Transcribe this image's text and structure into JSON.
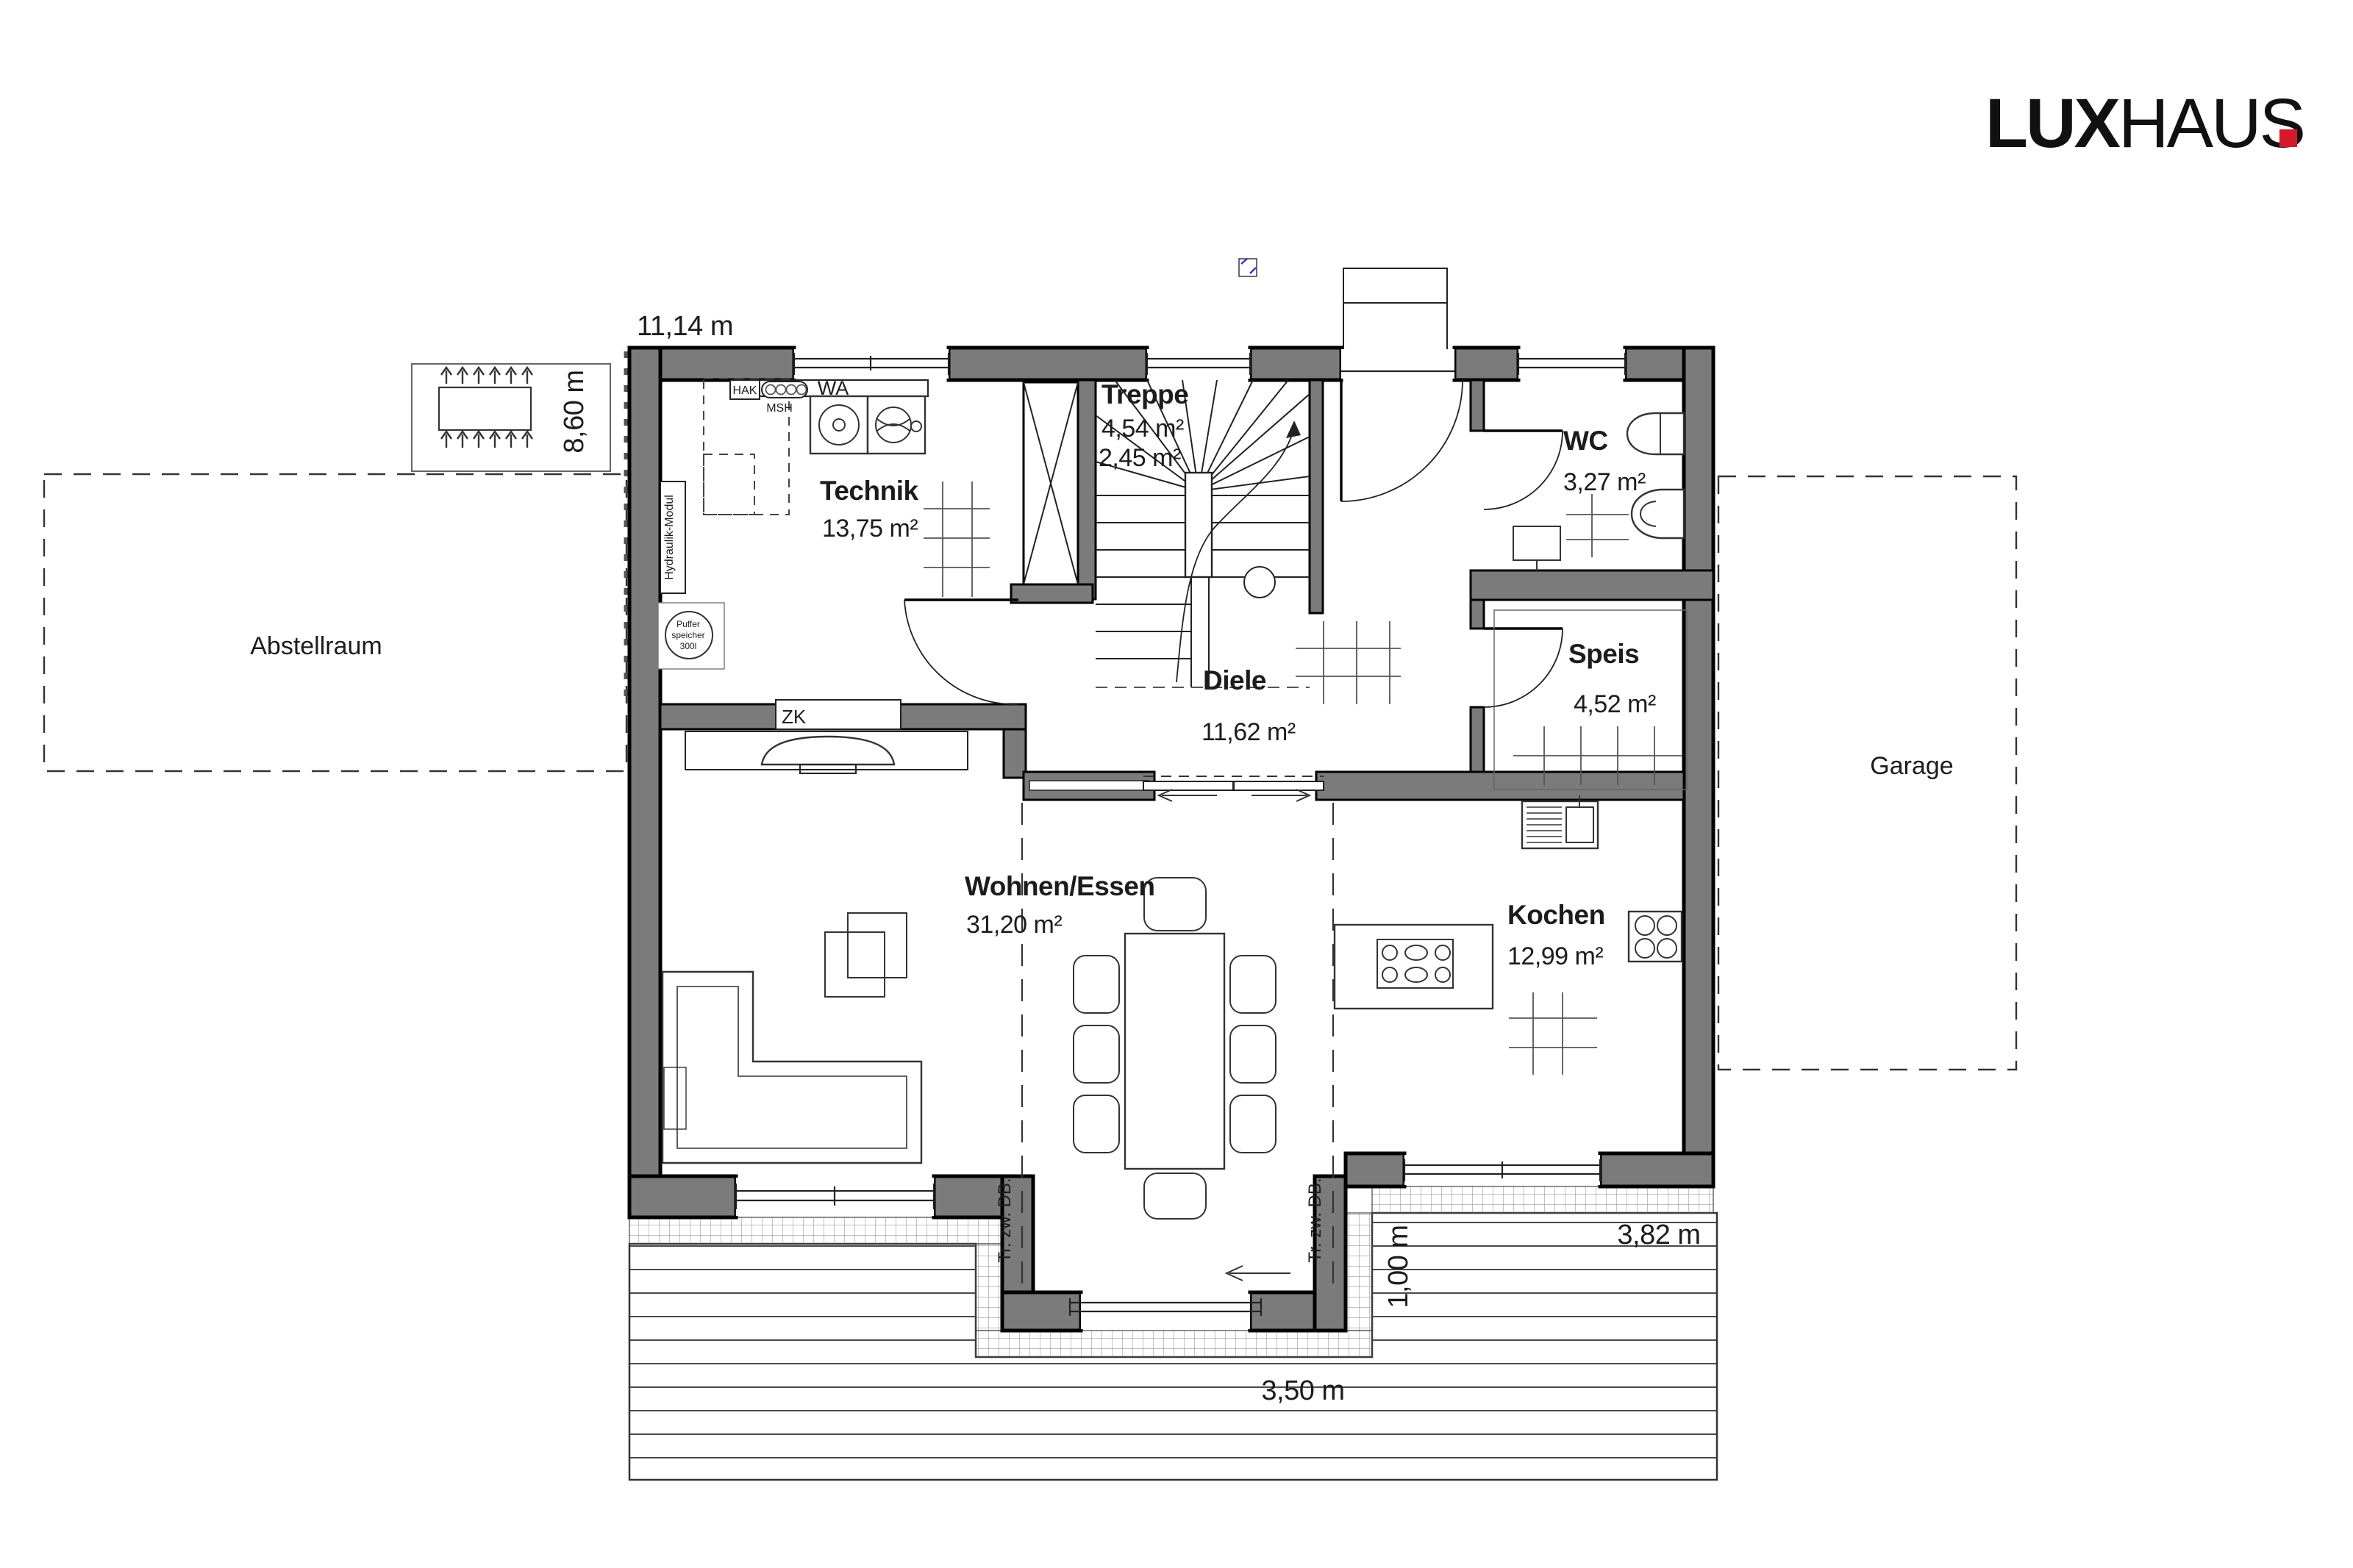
{
  "logo": {
    "lux": "LUX",
    "haus": "HAUS",
    "dot_color": "#d6182b"
  },
  "rooms": {
    "technik": {
      "name": "Technik",
      "area": "13,75 m²"
    },
    "treppe": {
      "name": "Treppe",
      "area1": "4,54 m²",
      "area2": "2,45 m²"
    },
    "wc": {
      "name": "WC",
      "area": "3,27 m²"
    },
    "diele": {
      "name": "Diele",
      "area": "11,62 m²"
    },
    "speis": {
      "name": "Speis",
      "area": "4,52 m²"
    },
    "wohnen_essen": {
      "name": "Wohnen/Essen",
      "area": "31,20 m²"
    },
    "kochen": {
      "name": "Kochen",
      "area": "12,99 m²"
    }
  },
  "outdoor": {
    "abstellraum": "Abstellraum",
    "garage": "Garage"
  },
  "dimensions": {
    "width_top": "11,14 m",
    "depth_left": "8,60 m",
    "bay_width": "3,50 m",
    "terrace_offset": "1,00 m",
    "terrace_right": "3,82 m"
  },
  "equipment": {
    "hak": "HAK",
    "msh": "MSH",
    "wa": "WA",
    "zk": "ZK",
    "hydraulik_modul": "Hydraulik-Modul",
    "puffer_line1": "Puffer",
    "puffer_line2": "speicher",
    "puffer_line3": "300l",
    "beam_note": "Tr. zw. DB."
  },
  "colors": {
    "wall": "#7b7b7b",
    "red": "#d6182b"
  }
}
